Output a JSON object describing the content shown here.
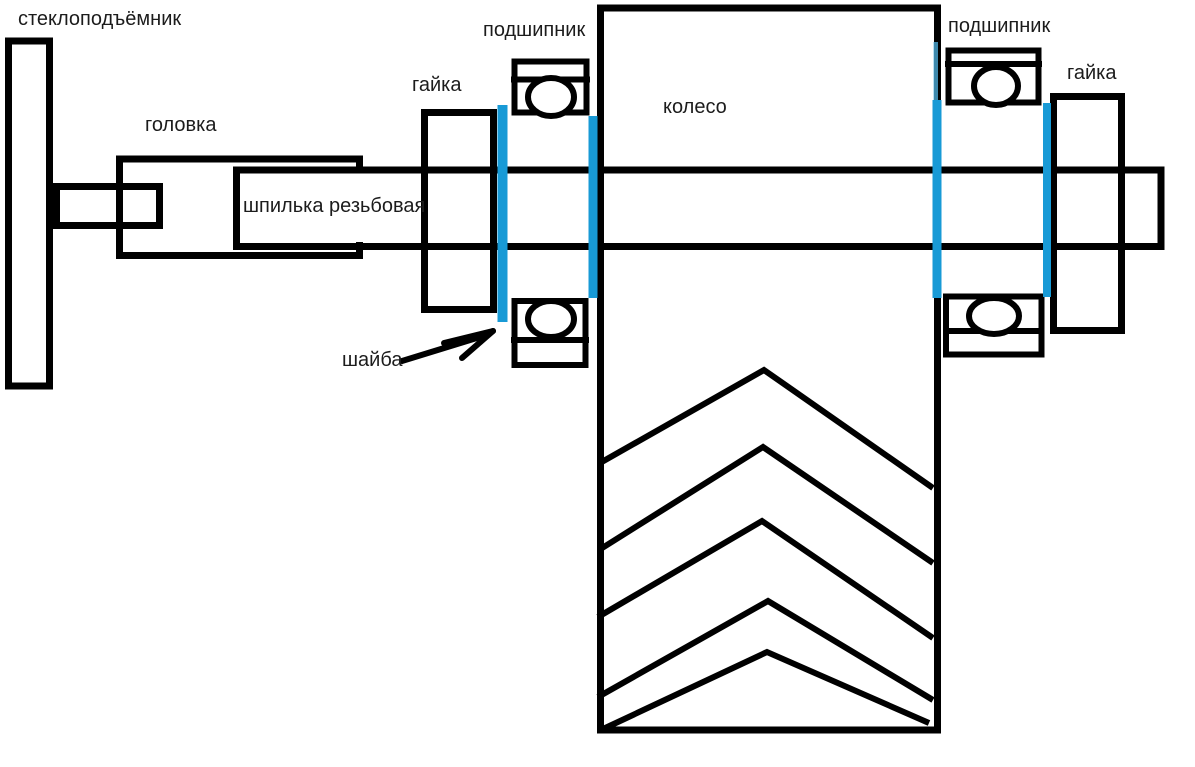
{
  "labels": {
    "window_lifter": {
      "text": "стеклоподъёмник"
    },
    "head": {
      "text": "головка"
    },
    "stud": {
      "text": "шпилька резьбовая"
    },
    "nut_left": {
      "text": "гайка"
    },
    "bearing_left": {
      "text": "подшипник"
    },
    "wheel": {
      "text": "колесо"
    },
    "bearing_right": {
      "text": "подшипник"
    },
    "nut_right": {
      "text": "гайка"
    },
    "washer": {
      "text": "шайба"
    }
  },
  "colors": {
    "line": "#000000",
    "washer": "#189AD6",
    "washer_light": "#4FB0DE",
    "background": "#FFFFFF"
  }
}
